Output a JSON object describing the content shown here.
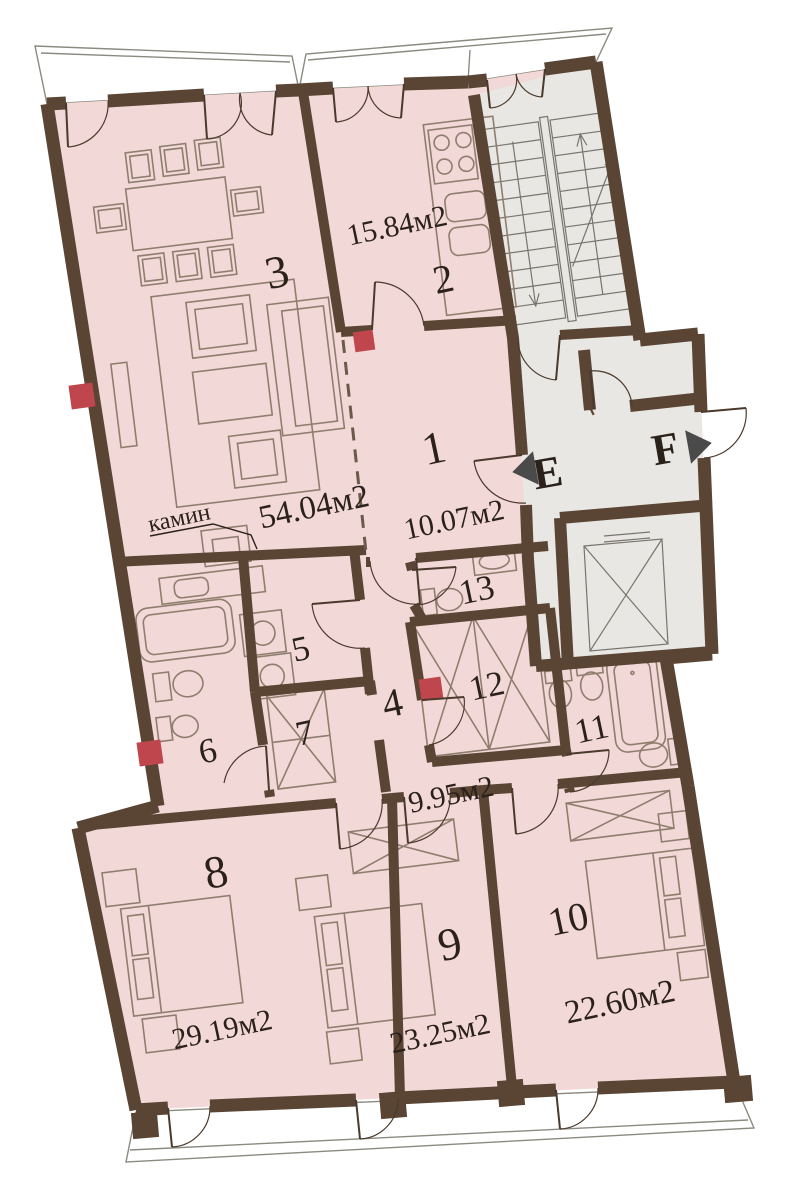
{
  "plan": {
    "rooms": [
      {
        "number": "1",
        "area": "10.07м2"
      },
      {
        "number": "2",
        "area": "15.84м2"
      },
      {
        "number": "3",
        "area": "54.04м2"
      },
      {
        "number": "4",
        "area": "9.95м2"
      },
      {
        "number": "5"
      },
      {
        "number": "6"
      },
      {
        "number": "7"
      },
      {
        "number": "8",
        "area": "29.19м2"
      },
      {
        "number": "9",
        "area": "23.25м2"
      },
      {
        "number": "10",
        "area": "22.60м2"
      },
      {
        "number": "11"
      },
      {
        "number": "12"
      },
      {
        "number": "13"
      }
    ],
    "annotations": {
      "fireplace": "камин",
      "lobby_marker_e": "E",
      "lobby_marker_f": "F"
    },
    "colors": {
      "room_fill": "#f3d8d8",
      "common_fill": "#e9e7e3",
      "wall": "#5a4535",
      "accent_red": "#c0464e",
      "furniture_line": "#8f7e6e",
      "text": "#2a211a"
    }
  }
}
